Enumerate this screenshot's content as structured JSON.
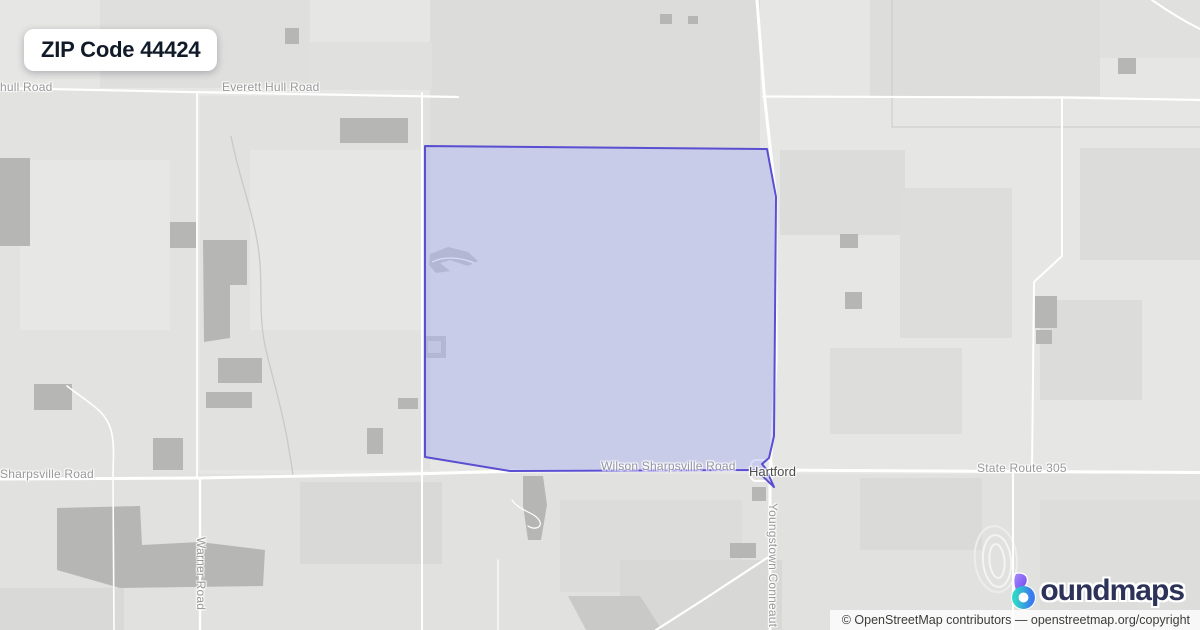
{
  "badge": {
    "title": "ZIP Code 44424"
  },
  "map": {
    "labels": {
      "hull_road": "hull Road",
      "everett_hull_road": "Everett Hull Road",
      "sharpsville_road": "Sharpsville Road",
      "wilson_sharpsville_road": "Wilson Sharpsville Road",
      "hartford": "Hartford",
      "state_route_305": "State Route 305",
      "warner_road": "Warner Road",
      "youngstown_conneaut": "Youngstown Conneaut"
    },
    "boundary": {
      "stroke_color": "#5a4ed1",
      "fill_color": "rgba(145,155,240,0.35)"
    }
  },
  "logo": {
    "brand": "boundmaps",
    "text_rest": "oundmaps",
    "icon": "boundmaps-drop-icon",
    "colors": {
      "purple": "#8a5cf6",
      "teal": "#2fd5c8",
      "blue": "#3a7bf0",
      "navy": "#2d3258"
    }
  },
  "attribution": {
    "text": "© OpenStreetMap contributors — openstreetmap.org/copyright"
  }
}
